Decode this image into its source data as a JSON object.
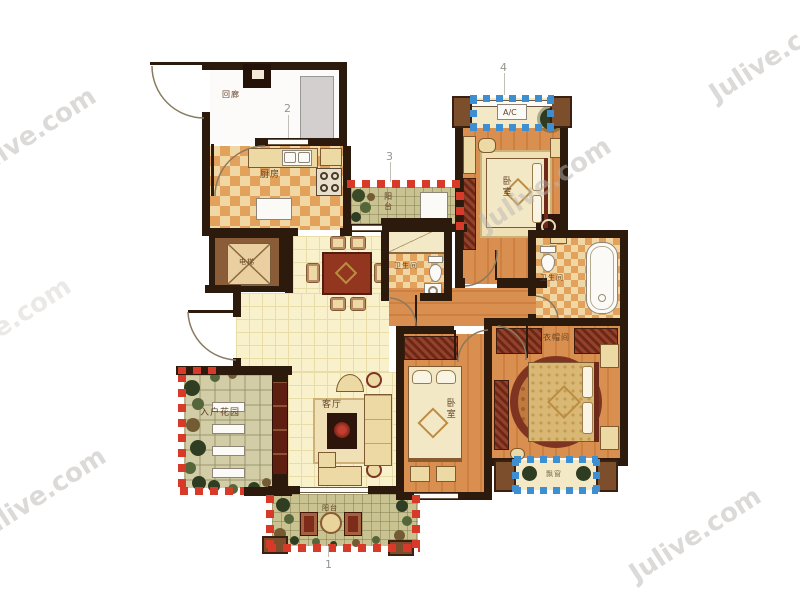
{
  "rooms": {
    "corridor": "回廊",
    "kitchen": "厨房",
    "balcony_top": "阳台",
    "balcony_bottom": "阳台",
    "bathroom_mid": "卫生间",
    "bathroom_master": "卫生间",
    "bedroom_top": "卧室",
    "bedroom_mid": "卧室",
    "closet": "衣帽间",
    "living": "客厅",
    "garden": "入户花园",
    "elevator": "电梯",
    "ac_unit": "A/C",
    "bay_window": "飘窗"
  },
  "markers": {
    "n1": "1",
    "n2": "2",
    "n3": "3",
    "n4": "4"
  },
  "watermark": {
    "text": "Julive.com"
  },
  "colors": {
    "wall": "#2c1a0d",
    "open_edge_red": "#d83a2a",
    "bay_window_blue": "#3e8ed2",
    "tile_floor": "#f8f1cb",
    "wood_floor": "#d98f4f",
    "background": "#ffffff"
  }
}
